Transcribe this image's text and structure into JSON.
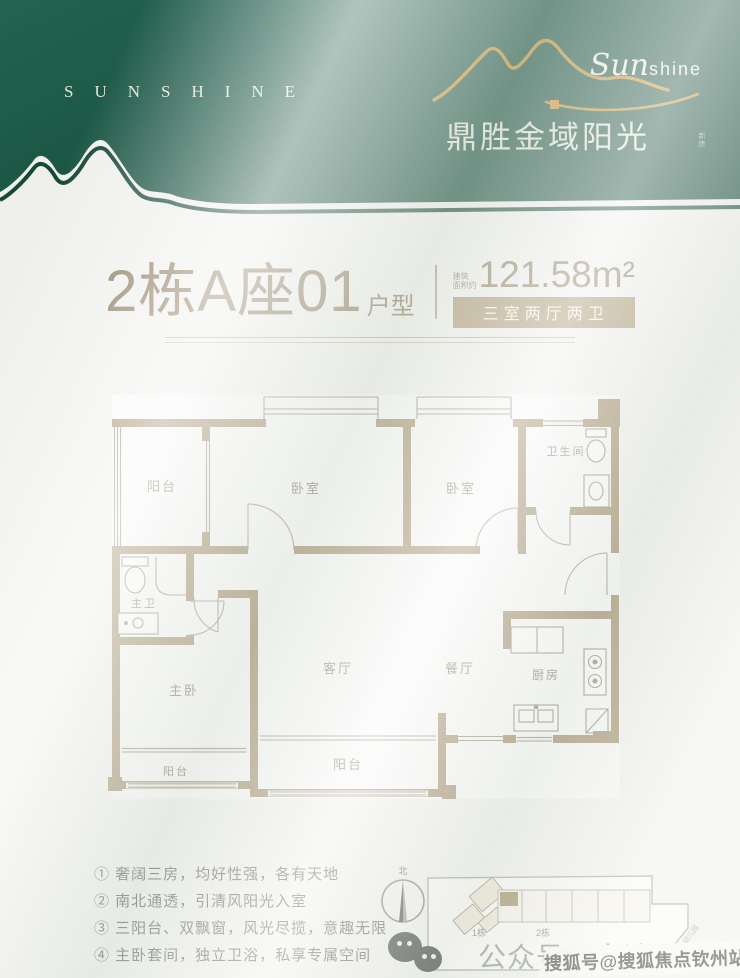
{
  "colors": {
    "header_green": "#1a5342",
    "gold": "#bf8c2b",
    "wall_tan": "#9e8a64",
    "badge_tan": "#a6916a",
    "title_taupe": "#8b7a5e"
  },
  "header": {
    "brand_spaced": "SUNSHINE",
    "logo_script": "Sun",
    "logo_script_rest": "shine",
    "brand_cn": "鼎胜金域阳光",
    "brand_tag": "新房"
  },
  "title": {
    "main": "2栋A座01",
    "suffix": "户型",
    "area_label_1": "建筑",
    "area_label_2": "面积约",
    "area_value": "121.58m²",
    "badge": "三室两厅两卫"
  },
  "floorplan": {
    "rooms": [
      {
        "label": "阳台"
      },
      {
        "label": "卧室"
      },
      {
        "label": "卧室"
      },
      {
        "label": "卫生间"
      },
      {
        "label": "主卫"
      },
      {
        "label": "主卧"
      },
      {
        "label": "客厅"
      },
      {
        "label": "餐厅"
      },
      {
        "label": "厨房"
      },
      {
        "label": "阳台"
      },
      {
        "label": "阳台"
      }
    ]
  },
  "features": {
    "items": [
      "① 奢阔三房，均好性强，各有天地",
      "② 南北通透，引清风阳光入室",
      "③ 三阳台、双飘窗，风光尽揽，意趣无限",
      "④ 主卧套间，独立卫浴，私享专属空间"
    ]
  },
  "siteplan": {
    "north_label": "北",
    "building1_label": "1栋",
    "building2_label": "2栋",
    "road_label": "幼儿园"
  },
  "footer": {
    "account_text": "公众号：南波哇楼市",
    "watermark": "搜狐号@搜狐焦点钦州站"
  }
}
